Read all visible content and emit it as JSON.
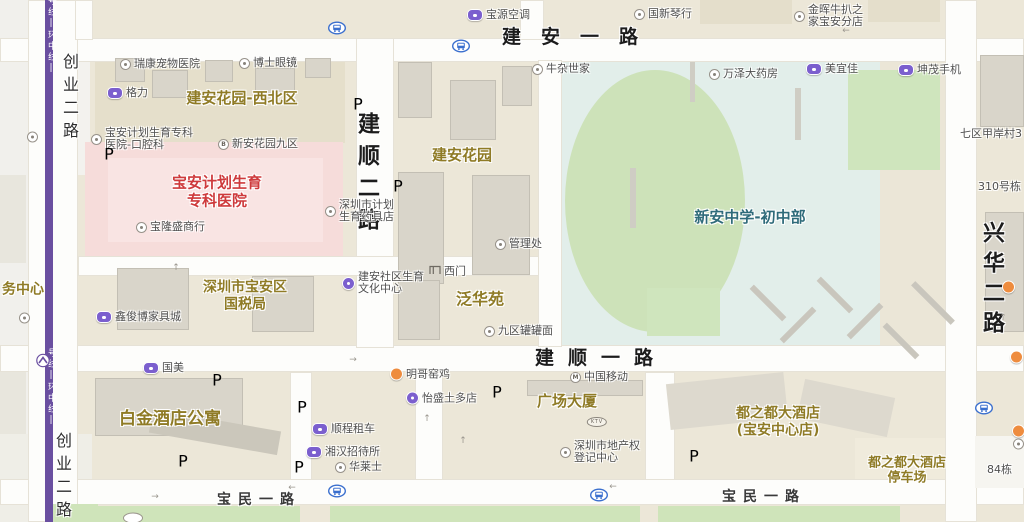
{
  "map": {
    "colors": {
      "road_text": "#1c1c1c",
      "area_label": "#8f7b26",
      "hospital_red": "#ce3a3c",
      "school_teal": "#2f6b7a",
      "metro_line_purple": "#6a4fa0",
      "parking_blue": "#2e7ad2",
      "bus_blue": "#3a6fce",
      "poi_gray": "#4f4f4f",
      "hospital_zone_pink": "#f6dcda",
      "school_zone": "#e2eeea",
      "field_green": "#cde2b9"
    },
    "road_labels": [
      {
        "name": "road-label-jianan-yilu",
        "text": "建安一路",
        "x": 502,
        "y": 22,
        "kind": "xl",
        "dir": "h",
        "size": 19,
        "ls": 20
      },
      {
        "name": "road-label-jianshun-yilu",
        "text": "建顺一路",
        "x": 535,
        "y": 343,
        "kind": "xl",
        "dir": "h",
        "size": 19,
        "ls": 14
      },
      {
        "name": "road-label-jianshun-erlu",
        "text": "建顺二路",
        "x": 350,
        "y": 112,
        "kind": "xl",
        "dir": "v",
        "size": 22,
        "ls": 10
      },
      {
        "name": "road-label-xinghua-erlu",
        "text": "兴华二路",
        "x": 975,
        "y": 221,
        "kind": "xl",
        "dir": "v",
        "size": 22,
        "ls": 8
      },
      {
        "name": "road-label-baomin-yilu-west",
        "text": "宝民一路",
        "x": 217,
        "y": 489,
        "kind": "md",
        "dir": "h",
        "size": 14,
        "ls": 7
      },
      {
        "name": "road-label-baomin-yilu-east",
        "text": "宝民一路",
        "x": 722,
        "y": 486,
        "kind": "md",
        "dir": "h",
        "size": 14,
        "ls": 7
      },
      {
        "name": "road-label-chuangye-erlu-north",
        "text": "创业二路",
        "x": 57,
        "y": 53,
        "kind": "sm",
        "dir": "v",
        "size": 16,
        "ls": 7
      },
      {
        "name": "road-label-chuangye-erlu-south",
        "text": "创业二路",
        "x": 50,
        "y": 432,
        "kind": "sm",
        "dir": "v",
        "size": 16,
        "ls": 7
      },
      {
        "name": "metro-line-label-north",
        "text": "号线|环中线|",
        "x": 45,
        "y": -4,
        "kind": "metro",
        "dir": "v",
        "size": 9,
        "ls": 2
      },
      {
        "name": "metro-line-label-south",
        "text": "号线|环中线|",
        "x": 45,
        "y": 348,
        "kind": "metro",
        "dir": "v",
        "size": 9,
        "ls": 2
      }
    ],
    "area_labels": [
      {
        "name": "area-jianan-garden-northwest",
        "lines": [
          "建安花园-西北区"
        ],
        "x": 242,
        "y": 99,
        "kind": "",
        "size": 15
      },
      {
        "name": "area-baoan-family-planning-hospital",
        "lines": [
          "宝安计划生育",
          "专科医院"
        ],
        "x": 217,
        "y": 192,
        "kind": "area-red",
        "size": 15
      },
      {
        "name": "area-jianan-garden",
        "lines": [
          "建安花园"
        ],
        "x": 462,
        "y": 156,
        "kind": "",
        "size": 15
      },
      {
        "name": "area-xinan-middle-school",
        "lines": [
          "新安中学-初中部"
        ],
        "x": 750,
        "y": 218,
        "kind": "area-teal",
        "size": 15
      },
      {
        "name": "area-fanhuayuan",
        "lines": [
          "泛华苑"
        ],
        "x": 480,
        "y": 300,
        "kind": "",
        "size": 16
      },
      {
        "name": "area-baoan-tax-bureau",
        "lines": [
          "深圳市宝安区",
          "国税局"
        ],
        "x": 245,
        "y": 296,
        "kind": "",
        "size": 14
      },
      {
        "name": "area-service-center-cut",
        "lines": [
          "务中心"
        ],
        "x": 23,
        "y": 290,
        "kind": "",
        "size": 14
      },
      {
        "name": "area-platinum-hotel-apartment",
        "lines": [
          "白金酒店公寓"
        ],
        "x": 170,
        "y": 419,
        "kind": "",
        "size": 17
      },
      {
        "name": "area-guangchang-dasha",
        "lines": [
          "广场大厦"
        ],
        "x": 567,
        "y": 402,
        "kind": "",
        "size": 15
      },
      {
        "name": "area-duzhidu-hotel",
        "lines": [
          "都之都大酒店",
          "(宝安中心店)"
        ],
        "x": 778,
        "y": 422,
        "kind": "",
        "size": 14
      },
      {
        "name": "area-duzhidu-hotel-parking",
        "lines": [
          "都之都大酒店",
          "停车场"
        ],
        "x": 907,
        "y": 471,
        "kind": "",
        "size": 13
      }
    ],
    "poi_labels": [
      {
        "name": "poi-ruikang-pet-hospital",
        "icon": "ring",
        "lines": [
          "瑞康宠物医院"
        ],
        "x": 126,
        "y": 64
      },
      {
        "name": "poi-boshi-glasses",
        "icon": "ring",
        "lines": [
          "博士眼镜"
        ],
        "x": 245,
        "y": 63
      },
      {
        "name": "poi-gree",
        "icon": "purple",
        "lines": [
          "格力"
        ],
        "x": 113,
        "y": 93
      },
      {
        "name": "poi-family-planning-dental",
        "icon": "ring",
        "lines": [
          "宝安计划生育专科",
          "医院-口腔科"
        ],
        "x": 97,
        "y": 139
      },
      {
        "name": "poi-xinan-garden-9",
        "icon": "ring",
        "letter": "B",
        "lines": [
          "新安花园九区"
        ],
        "x": 224,
        "y": 144
      },
      {
        "name": "poi-baolongsheng-store",
        "icon": "ring",
        "lines": [
          "宝隆盛商行"
        ],
        "x": 142,
        "y": 227
      },
      {
        "name": "poi-family-planning-supplies",
        "icon": "ring",
        "lines": [
          "深圳市计划",
          "生育药具店"
        ],
        "x": 331,
        "y": 211
      },
      {
        "name": "poi-baoyuan-aircon",
        "icon": "purple",
        "lines": [
          "宝源空调"
        ],
        "x": 473,
        "y": 15
      },
      {
        "name": "poi-guoxin-piano",
        "icon": "ring",
        "lines": [
          "国新琴行"
        ],
        "x": 640,
        "y": 14
      },
      {
        "name": "poi-jinhui-steak-house",
        "icon": "ring",
        "lines": [
          "金晖牛扒之",
          "家宝安分店"
        ],
        "x": 800,
        "y": 16
      },
      {
        "name": "poi-niuza-shijia",
        "icon": "ring",
        "lines": [
          "牛杂世家"
        ],
        "x": 538,
        "y": 69
      },
      {
        "name": "poi-wanze-pharmacy",
        "icon": "ring",
        "lines": [
          "万泽大药房"
        ],
        "x": 715,
        "y": 74
      },
      {
        "name": "poi-meiyijia",
        "icon": "purple",
        "lines": [
          "美宜佳"
        ],
        "x": 812,
        "y": 69
      },
      {
        "name": "poi-kunmao-mobile",
        "icon": "purple",
        "lines": [
          "坤茂手机"
        ],
        "x": 904,
        "y": 70
      },
      {
        "name": "poi-qiqu-jiaan-village",
        "icon": "none",
        "lines": [
          "七区甲岸村3"
        ],
        "x": 966,
        "y": 134
      },
      {
        "name": "poi-no310-building",
        "icon": "none",
        "lines": [
          "310号栋"
        ],
        "x": 984,
        "y": 187
      },
      {
        "name": "poi-management-office",
        "icon": "ring",
        "lines": [
          "管理处"
        ],
        "x": 501,
        "y": 244
      },
      {
        "name": "poi-west-gate",
        "icon": "gate",
        "lines": [
          "西门"
        ],
        "x": 435,
        "y": 271
      },
      {
        "name": "poi-jianan-community-center",
        "icon": "pcircle",
        "lines": [
          "建安社区生育",
          "文化中心"
        ],
        "x": 348,
        "y": 283
      },
      {
        "name": "poi-jiuqu-noodles",
        "icon": "ring",
        "lines": [
          "九区罐罐面"
        ],
        "x": 490,
        "y": 331
      },
      {
        "name": "poi-xinjunbo-furniture",
        "icon": "purple",
        "lines": [
          "鑫俊博家具城"
        ],
        "x": 102,
        "y": 317
      },
      {
        "name": "poi-gome",
        "icon": "purple",
        "lines": [
          "国美"
        ],
        "x": 149,
        "y": 368
      },
      {
        "name": "poi-mingge-roast-chicken",
        "icon": "orange",
        "lines": [
          "明哥窑鸡"
        ],
        "x": 396,
        "y": 374
      },
      {
        "name": "poi-yisheng-store",
        "icon": "pcircle",
        "lines": [
          "怡盛土多店"
        ],
        "x": 412,
        "y": 398
      },
      {
        "name": "poi-shuncheng-car-rental",
        "icon": "purple",
        "lines": [
          "顺程租车"
        ],
        "x": 318,
        "y": 429
      },
      {
        "name": "poi-xianghan-hostel",
        "icon": "purple",
        "lines": [
          "湘汉招待所"
        ],
        "x": 312,
        "y": 452
      },
      {
        "name": "poi-hualaishi",
        "icon": "ring",
        "lines": [
          "华莱士"
        ],
        "x": 341,
        "y": 467
      },
      {
        "name": "poi-china-mobile",
        "icon": "ring",
        "letter": "M",
        "lines": [
          "中国移动"
        ],
        "x": 576,
        "y": 377
      },
      {
        "name": "poi-real-estate-registry",
        "icon": "ring",
        "lines": [
          "深圳市地产权",
          "登记中心"
        ],
        "x": 566,
        "y": 452
      },
      {
        "name": "poi-building-84",
        "icon": "none",
        "lines": [
          "84栋"
        ],
        "x": 993,
        "y": 470
      },
      {
        "name": "poi-left-edge-dot-1",
        "icon": "ring",
        "lines": [],
        "x": 33,
        "y": 137
      },
      {
        "name": "poi-left-edge-dot-2",
        "icon": "ring",
        "lines": [],
        "x": 25,
        "y": 318
      },
      {
        "name": "poi-right-edge-dot-1",
        "icon": "orange",
        "lines": [],
        "x": 1008,
        "y": 287
      },
      {
        "name": "poi-right-edge-dot-2",
        "icon": "orange",
        "lines": [],
        "x": 1016,
        "y": 357
      },
      {
        "name": "poi-right-edge-dot-3",
        "icon": "orange",
        "lines": [],
        "x": 1018,
        "y": 431
      },
      {
        "name": "poi-right-edge-dot-4",
        "icon": "ring",
        "lines": [],
        "x": 1019,
        "y": 444
      }
    ],
    "badges": [
      {
        "name": "parking-icon",
        "kind": "parking",
        "text": "P",
        "x": 109,
        "y": 154
      },
      {
        "name": "parking-icon",
        "kind": "parking",
        "text": "P",
        "x": 358,
        "y": 104
      },
      {
        "name": "parking-icon",
        "kind": "parking",
        "text": "P",
        "x": 398,
        "y": 186
      },
      {
        "name": "parking-icon",
        "kind": "parking",
        "text": "P",
        "x": 217,
        "y": 380
      },
      {
        "name": "parking-icon",
        "kind": "parking",
        "text": "P",
        "x": 183,
        "y": 461
      },
      {
        "name": "parking-icon",
        "kind": "parking",
        "text": "P",
        "x": 302,
        "y": 407
      },
      {
        "name": "parking-icon",
        "kind": "parking",
        "text": "P",
        "x": 299,
        "y": 467
      },
      {
        "name": "parking-icon",
        "kind": "parking",
        "text": "P",
        "x": 497,
        "y": 392
      },
      {
        "name": "parking-icon",
        "kind": "parking",
        "text": "P",
        "x": 694,
        "y": 456
      },
      {
        "name": "bus-stop-icon",
        "kind": "bus",
        "x": 337,
        "y": 29
      },
      {
        "name": "bus-stop-icon",
        "kind": "bus",
        "x": 461,
        "y": 47
      },
      {
        "name": "bus-stop-icon",
        "kind": "bus",
        "x": 337,
        "y": 492
      },
      {
        "name": "bus-stop-icon",
        "kind": "bus",
        "x": 599,
        "y": 496
      },
      {
        "name": "bus-stop-icon",
        "kind": "bus",
        "x": 984,
        "y": 409
      },
      {
        "name": "metro-station-icon",
        "kind": "metro",
        "x": 43,
        "y": 362
      },
      {
        "name": "ktv-badge",
        "kind": "ktv",
        "text": "KTV",
        "x": 597,
        "y": 422
      },
      {
        "name": "oval-stub-icon",
        "kind": "oval",
        "x": 133,
        "y": 518
      }
    ],
    "arrows": [
      {
        "g": "←",
        "x": 292,
        "y": 488
      },
      {
        "g": "→",
        "x": 155,
        "y": 497
      },
      {
        "g": "→",
        "x": 353,
        "y": 360
      },
      {
        "g": "↑",
        "x": 427,
        "y": 419
      },
      {
        "g": "←",
        "x": 846,
        "y": 31
      },
      {
        "g": "←",
        "x": 613,
        "y": 487
      },
      {
        "g": "↑",
        "x": 463,
        "y": 441
      },
      {
        "g": "↑",
        "x": 1003,
        "y": 318
      },
      {
        "g": "↑",
        "x": 176,
        "y": 268
      }
    ]
  }
}
